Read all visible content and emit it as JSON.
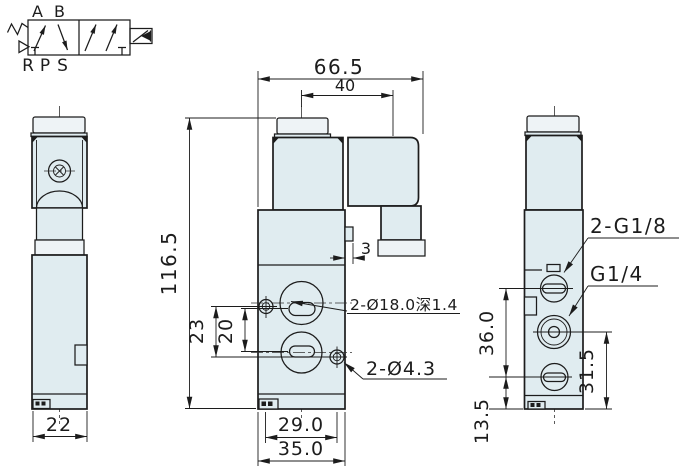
{
  "colors": {
    "body_fill": "#e0ecf0",
    "line": "#1c1c1c",
    "background": "#ffffff"
  },
  "schematic": {
    "port_a": "A",
    "port_b": "B",
    "port_r": "R",
    "port_p": "P",
    "port_s": "S"
  },
  "left_view": {
    "width": "22"
  },
  "front_view": {
    "overall_width": "66.5",
    "coil_width": "40",
    "overall_height": "116.5",
    "hole_span_vertical": "23",
    "recess_span_vertical": "20",
    "tab_width": "3",
    "recess_label": "2-Ø18.0深1.4",
    "mount_hole_label": "2-Ø4.3",
    "hole_span_horizontal": "29.0",
    "base_width": "35.0"
  },
  "right_view": {
    "side_port_label": "2-G1/8",
    "center_port_label": "G1/4",
    "port_span": "36.0",
    "lower_port_height": "31.5",
    "bottom_offset": "13.5"
  }
}
